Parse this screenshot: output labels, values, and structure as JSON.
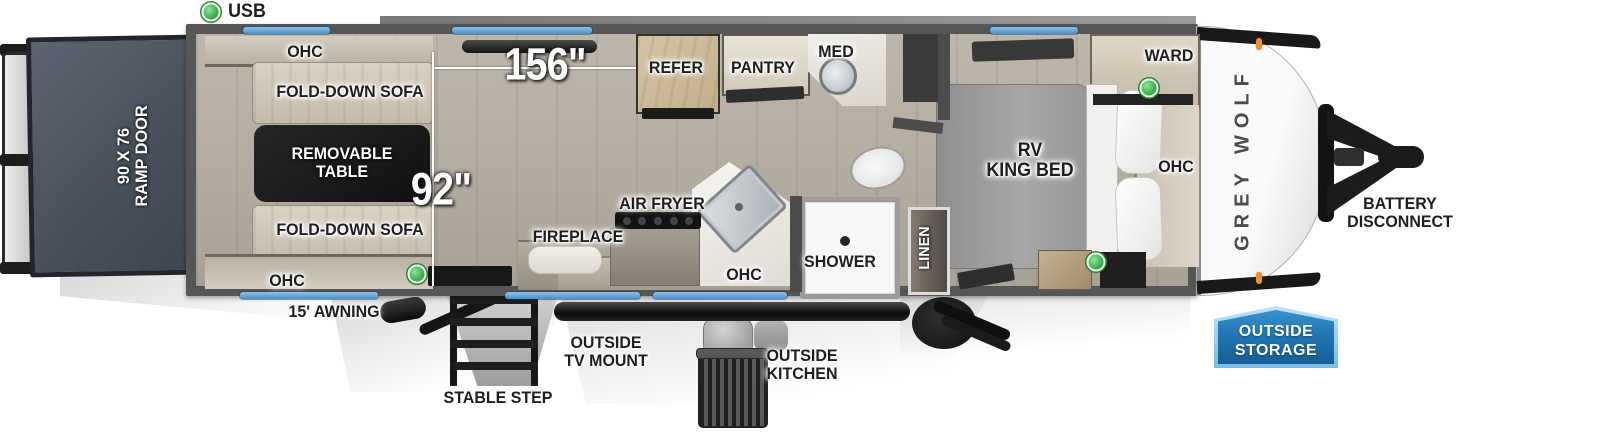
{
  "legend": {
    "usb": "USB"
  },
  "brand": {
    "name": "GREY WOLF"
  },
  "dims": {
    "length": "156\"",
    "width": "92\""
  },
  "rear": {
    "ramp_door_line1": "90 X 76",
    "ramp_door_line2": "RAMP DOOR"
  },
  "garage": {
    "ohc_top": "OHC",
    "sofa_top": "FOLD-DOWN SOFA",
    "table_line1": "REMOVABLE",
    "table_line2": "TABLE",
    "sofa_bottom": "FOLD-DOWN SOFA",
    "ohc_bottom": "OHC"
  },
  "kitchen": {
    "refer": "REFER",
    "pantry": "PANTRY",
    "air_fryer": "AIR FRYER",
    "fireplace": "FIREPLACE",
    "ohc": "OHC"
  },
  "bath": {
    "med": "MED",
    "shower": "SHOWER",
    "linen": "LINEN"
  },
  "bedroom": {
    "bed_line1": "RV",
    "bed_line2": "KING BED",
    "ward": "WARD",
    "ohc": "OHC"
  },
  "exterior": {
    "awning": "15' AWNING",
    "tv_mount_line1": "OUTSIDE",
    "tv_mount_line2": "TV MOUNT",
    "stable_step": "STABLE STEP",
    "outside_kitchen_line1": "OUTSIDE",
    "outside_kitchen_line2": "KITCHEN",
    "storage_line1": "OUTSIDE",
    "storage_line2": "STORAGE",
    "battery_line1": "BATTERY",
    "battery_line2": "DISCONNECT"
  },
  "colors": {
    "window_blue": "#5b9fd4",
    "badge_blue": "#2077b5",
    "badge_border": "#9ed4f2",
    "indicator_green": "#35ad46",
    "marker_orange": "#e8922a",
    "wall_gray": "#555555",
    "floor_wood": "#b6afa4",
    "ramp_slate": "#4d5560",
    "table_black": "#161616"
  }
}
